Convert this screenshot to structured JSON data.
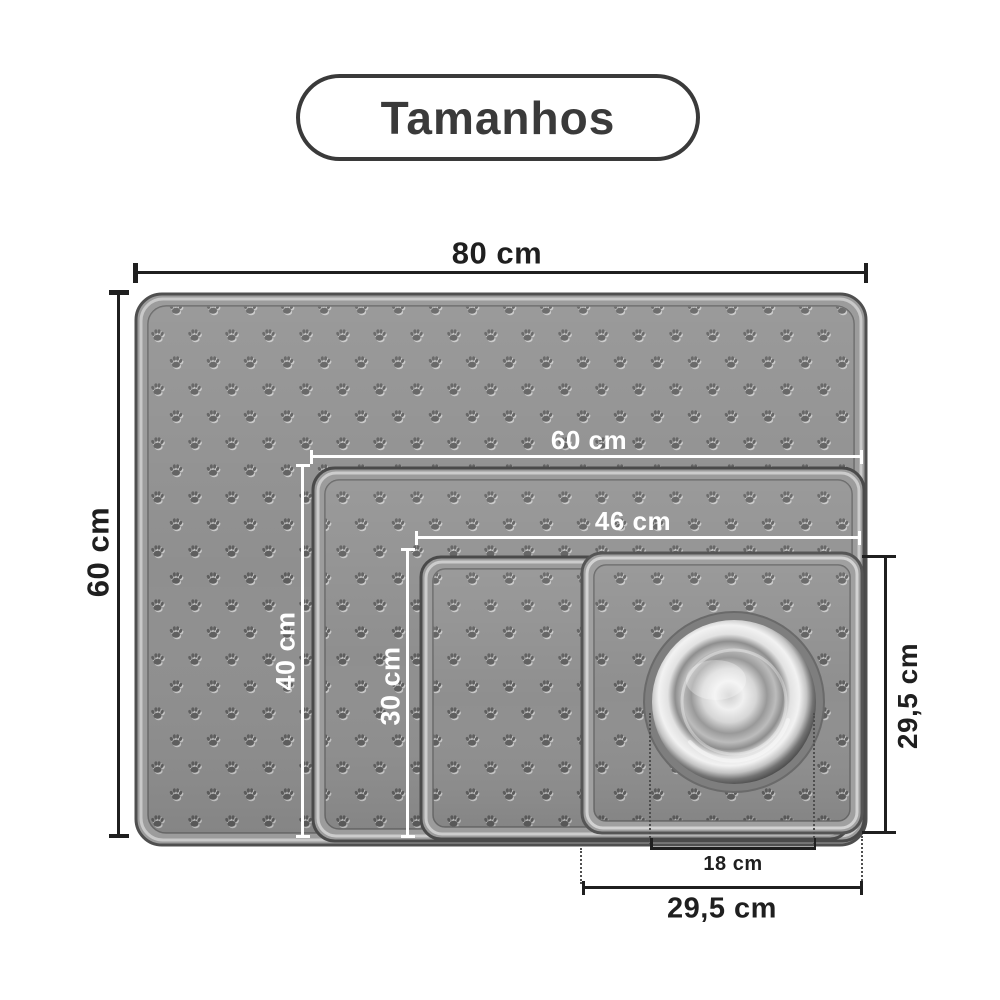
{
  "title": "Tamanhos",
  "mats": [
    {
      "name": "extra-large",
      "width_label": "80 cm",
      "height_label": "60 cm"
    },
    {
      "name": "large",
      "width_label": "60 cm",
      "height_label": "40 cm"
    },
    {
      "name": "medium",
      "width_label": "46 cm",
      "height_label": "30 cm"
    },
    {
      "name": "small",
      "width_label": "29,5 cm",
      "height_label": "29,5 cm"
    }
  ],
  "bowl": {
    "diameter_label": "18 cm"
  },
  "colors": {
    "ink": "#1f1f1f",
    "line_white": "#ffffff",
    "title_ink": "#3a3a3a",
    "mat_gray": "#8f8f8f",
    "bg": "#ffffff"
  }
}
